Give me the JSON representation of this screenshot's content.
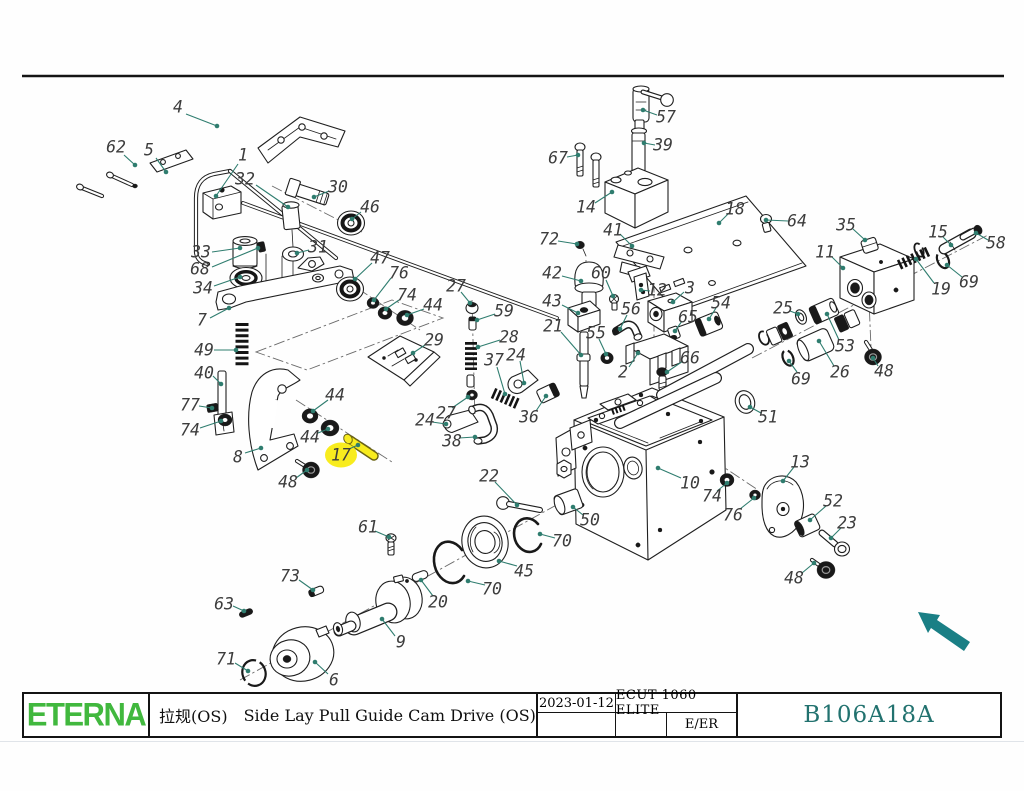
{
  "title_block": {
    "logo_text": "ETERNA",
    "drawing_title_cn": "拉规(OS)",
    "drawing_title_en": "Side Lay Pull Guide Cam Drive (OS)",
    "date": "2023-01-12",
    "machine_model": "ECUT 1060 ELITE",
    "revision_code": "E/ER",
    "drawing_number": "B106A18A"
  },
  "colors": {
    "logo_green": "#41b83e",
    "drawing_number_teal": "#22726f",
    "leader_teal": "#2f7d6f",
    "highlight_yellow": "#f8ec1e",
    "arrow_teal": "#1a7f85",
    "line_black": "#1c1c1c"
  },
  "highlight": {
    "part_number": "17"
  },
  "labels_format": [
    "part_number",
    "label_x",
    "label_y",
    "leader_x1",
    "leader_y1",
    "leader_x2",
    "leader_y2"
  ],
  "part_labels": [
    [
      "4",
      178,
      107,
      186,
      114,
      217,
      126
    ],
    [
      "62",
      116,
      147,
      124,
      155,
      135,
      165
    ],
    [
      "5",
      149,
      150,
      156,
      158,
      166,
      172
    ],
    [
      "1",
      243,
      155,
      238,
      164,
      216,
      196
    ],
    [
      "32",
      245,
      179,
      256,
      185,
      288,
      207
    ],
    [
      "30",
      338,
      187,
      329,
      191,
      314,
      197
    ],
    [
      "46",
      370,
      207,
      361,
      212,
      352,
      219
    ],
    [
      "33",
      201,
      252,
      212,
      252,
      240,
      248
    ],
    [
      "68",
      200,
      269,
      212,
      267,
      258,
      248
    ],
    [
      "31",
      318,
      247,
      309,
      250,
      297,
      253
    ],
    [
      "34",
      203,
      288,
      214,
      286,
      240,
      277
    ],
    [
      "7",
      202,
      320,
      210,
      318,
      229,
      308
    ],
    [
      "49",
      204,
      350,
      214,
      350,
      236,
      350
    ],
    [
      "40",
      204,
      373,
      213,
      376,
      221,
      384
    ],
    [
      "77",
      190,
      405,
      199,
      406,
      212,
      408
    ],
    [
      "74",
      190,
      430,
      200,
      428,
      221,
      421
    ],
    [
      "8",
      238,
      457,
      245,
      453,
      261,
      448
    ],
    [
      "48",
      288,
      482,
      296,
      478,
      307,
      470
    ],
    [
      "44",
      335,
      395,
      328,
      400,
      313,
      411
    ],
    [
      "44",
      310,
      437,
      318,
      433,
      328,
      429
    ],
    [
      "17",
      341,
      455,
      349,
      449,
      358,
      445
    ],
    [
      "24",
      425,
      420,
      432,
      422,
      446,
      424
    ],
    [
      "27",
      446,
      413,
      452,
      408,
      468,
      397
    ],
    [
      "38",
      452,
      441,
      459,
      438,
      475,
      437
    ],
    [
      "36",
      529,
      417,
      536,
      411,
      546,
      396
    ],
    [
      "29",
      434,
      340,
      425,
      345,
      413,
      353
    ],
    [
      "47",
      380,
      258,
      372,
      263,
      355,
      279
    ],
    [
      "76",
      399,
      273,
      391,
      278,
      374,
      300
    ],
    [
      "74",
      407,
      295,
      399,
      300,
      386,
      309
    ],
    [
      "44",
      433,
      305,
      424,
      309,
      407,
      315
    ],
    [
      "27",
      456,
      286,
      461,
      292,
      470,
      303
    ],
    [
      "59",
      504,
      311,
      495,
      314,
      477,
      320
    ],
    [
      "28",
      509,
      337,
      500,
      340,
      478,
      347
    ],
    [
      "37",
      494,
      360,
      497,
      367,
      505,
      394
    ],
    [
      "24",
      516,
      355,
      520,
      361,
      524,
      383
    ],
    [
      "61",
      368,
      527,
      375,
      531,
      389,
      537
    ],
    [
      "73",
      290,
      576,
      299,
      580,
      313,
      590
    ],
    [
      "63",
      224,
      604,
      233,
      606,
      244,
      611
    ],
    [
      "71",
      226,
      659,
      235,
      663,
      248,
      671
    ],
    [
      "6",
      334,
      680,
      328,
      674,
      315,
      662
    ],
    [
      "9",
      401,
      642,
      395,
      636,
      382,
      619
    ],
    [
      "20",
      438,
      602,
      433,
      596,
      421,
      580
    ],
    [
      "70",
      492,
      589,
      485,
      585,
      468,
      581
    ],
    [
      "45",
      524,
      571,
      517,
      566,
      499,
      561
    ],
    [
      "70",
      562,
      541,
      555,
      538,
      540,
      534
    ],
    [
      "50",
      590,
      520,
      583,
      515,
      573,
      507
    ],
    [
      "22",
      489,
      476,
      495,
      482,
      517,
      505
    ],
    [
      "10",
      690,
      483,
      681,
      478,
      658,
      468
    ],
    [
      "74",
      712,
      496,
      717,
      491,
      727,
      483
    ],
    [
      "76",
      733,
      515,
      740,
      509,
      754,
      498
    ],
    [
      "13",
      800,
      462,
      794,
      467,
      783,
      481
    ],
    [
      "52",
      833,
      501,
      826,
      506,
      810,
      520
    ],
    [
      "23",
      847,
      523,
      841,
      528,
      831,
      538
    ],
    [
      "48",
      794,
      578,
      802,
      573,
      814,
      563
    ],
    [
      "51",
      768,
      417,
      761,
      413,
      750,
      407
    ],
    [
      "69",
      801,
      379,
      797,
      372,
      789,
      361
    ],
    [
      "26",
      840,
      372,
      834,
      366,
      819,
      341
    ],
    [
      "53",
      845,
      346,
      839,
      340,
      827,
      314
    ],
    [
      "25",
      783,
      308,
      790,
      311,
      798,
      314
    ],
    [
      "48",
      884,
      371,
      878,
      366,
      873,
      358
    ],
    [
      "35",
      846,
      225,
      853,
      229,
      865,
      240
    ],
    [
      "11",
      825,
      252,
      832,
      257,
      843,
      268
    ],
    [
      "15",
      938,
      232,
      943,
      237,
      951,
      245
    ],
    [
      "58",
      996,
      243,
      988,
      240,
      976,
      233
    ],
    [
      "19",
      941,
      289,
      934,
      283,
      916,
      259
    ],
    [
      "69",
      969,
      282,
      962,
      277,
      947,
      265
    ],
    [
      "57",
      666,
      117,
      657,
      115,
      643,
      110
    ],
    [
      "39",
      663,
      145,
      655,
      145,
      644,
      143
    ],
    [
      "67",
      558,
      158,
      567,
      157,
      578,
      155
    ],
    [
      "14",
      586,
      207,
      595,
      203,
      612,
      192
    ],
    [
      "18",
      735,
      209,
      729,
      213,
      719,
      223
    ],
    [
      "64",
      797,
      221,
      788,
      221,
      766,
      220
    ],
    [
      "72",
      549,
      239,
      558,
      241,
      577,
      244
    ],
    [
      "41",
      613,
      230,
      620,
      234,
      632,
      246
    ],
    [
      "42",
      552,
      273,
      562,
      276,
      581,
      281
    ],
    [
      "60",
      601,
      273,
      606,
      280,
      613,
      296
    ],
    [
      "12",
      657,
      290,
      650,
      291,
      641,
      290
    ],
    [
      "3",
      690,
      288,
      684,
      292,
      673,
      302
    ],
    [
      "43",
      552,
      301,
      562,
      305,
      578,
      313
    ],
    [
      "56",
      631,
      309,
      627,
      315,
      620,
      329
    ],
    [
      "65",
      688,
      317,
      682,
      321,
      675,
      331
    ],
    [
      "54",
      721,
      303,
      716,
      308,
      709,
      319
    ],
    [
      "21",
      553,
      326,
      561,
      332,
      581,
      355
    ],
    [
      "55",
      596,
      333,
      599,
      339,
      606,
      354
    ],
    [
      "2",
      623,
      372,
      629,
      367,
      638,
      353
    ],
    [
      "66",
      690,
      358,
      683,
      361,
      667,
      372
    ]
  ]
}
